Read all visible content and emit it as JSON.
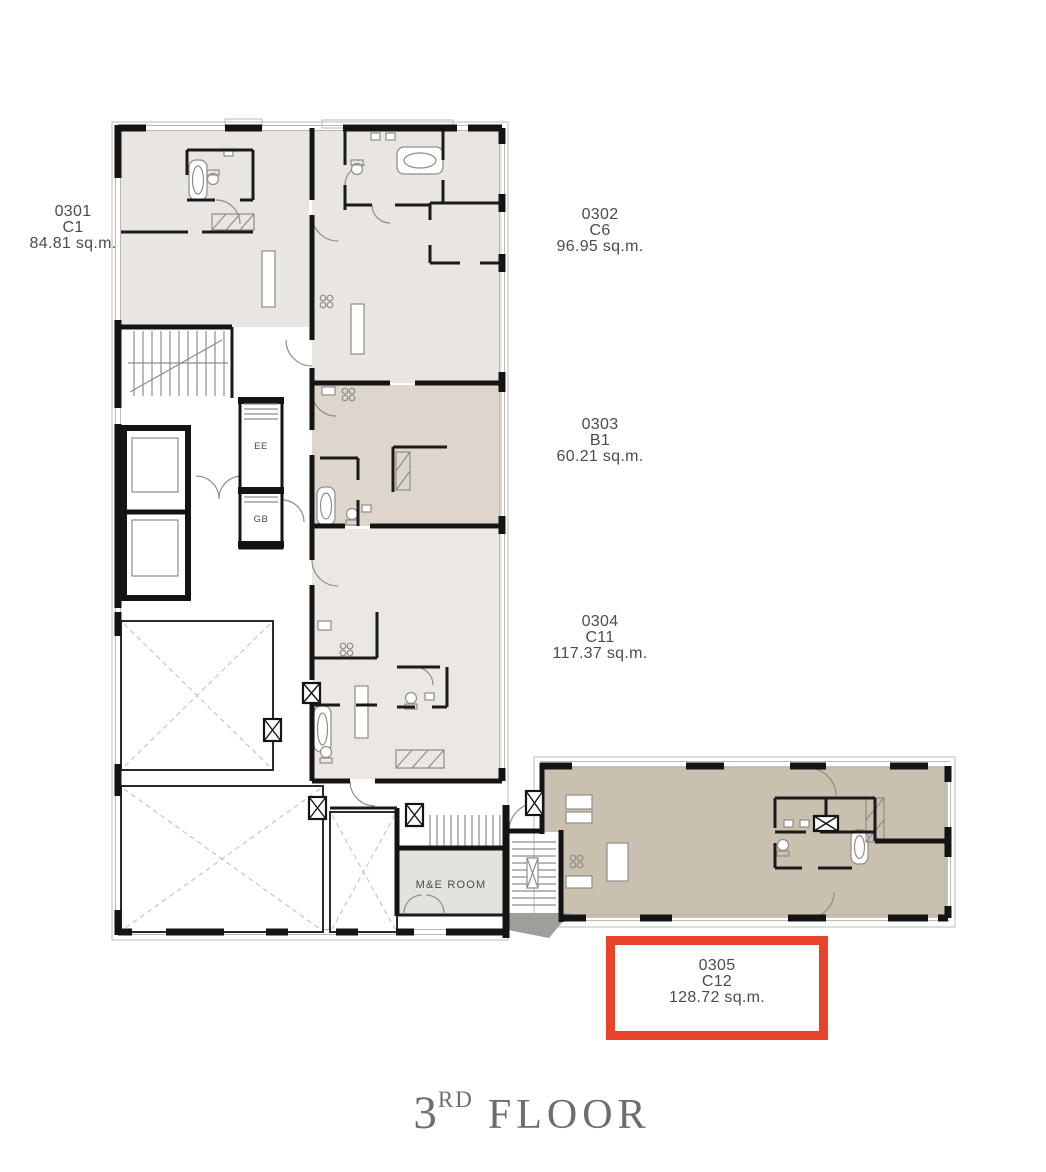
{
  "floor": {
    "number": "3",
    "ordinal_suffix": "RD",
    "word": "FLOOR"
  },
  "units": [
    {
      "id": "0301",
      "type": "C1",
      "area": "84.81 sq.m.",
      "highlighted": false
    },
    {
      "id": "0302",
      "type": "C6",
      "area": "96.95 sq.m.",
      "highlighted": false
    },
    {
      "id": "0303",
      "type": "B1",
      "area": "60.21 sq.m.",
      "highlighted": false
    },
    {
      "id": "0304",
      "type": "C11",
      "area": "117.37 sq.m.",
      "highlighted": false
    },
    {
      "id": "0305",
      "type": "C12",
      "area": "128.72 sq.m.",
      "highlighted": true
    }
  ],
  "plan_labels": {
    "ee": "EE",
    "gb": "GB",
    "me_room": "M&E ROOM"
  },
  "colors": {
    "highlight": "#e8432b",
    "unit_fill_light": "#e9e6e1",
    "unit_fill_taupe": "#ddd6cc",
    "unit_fill_brown": "#c9c0b0",
    "me_room_fill": "#e2e2df",
    "wall": "#141414",
    "label_text": "#4c4c4c",
    "title_text": "#6e6e6e"
  }
}
